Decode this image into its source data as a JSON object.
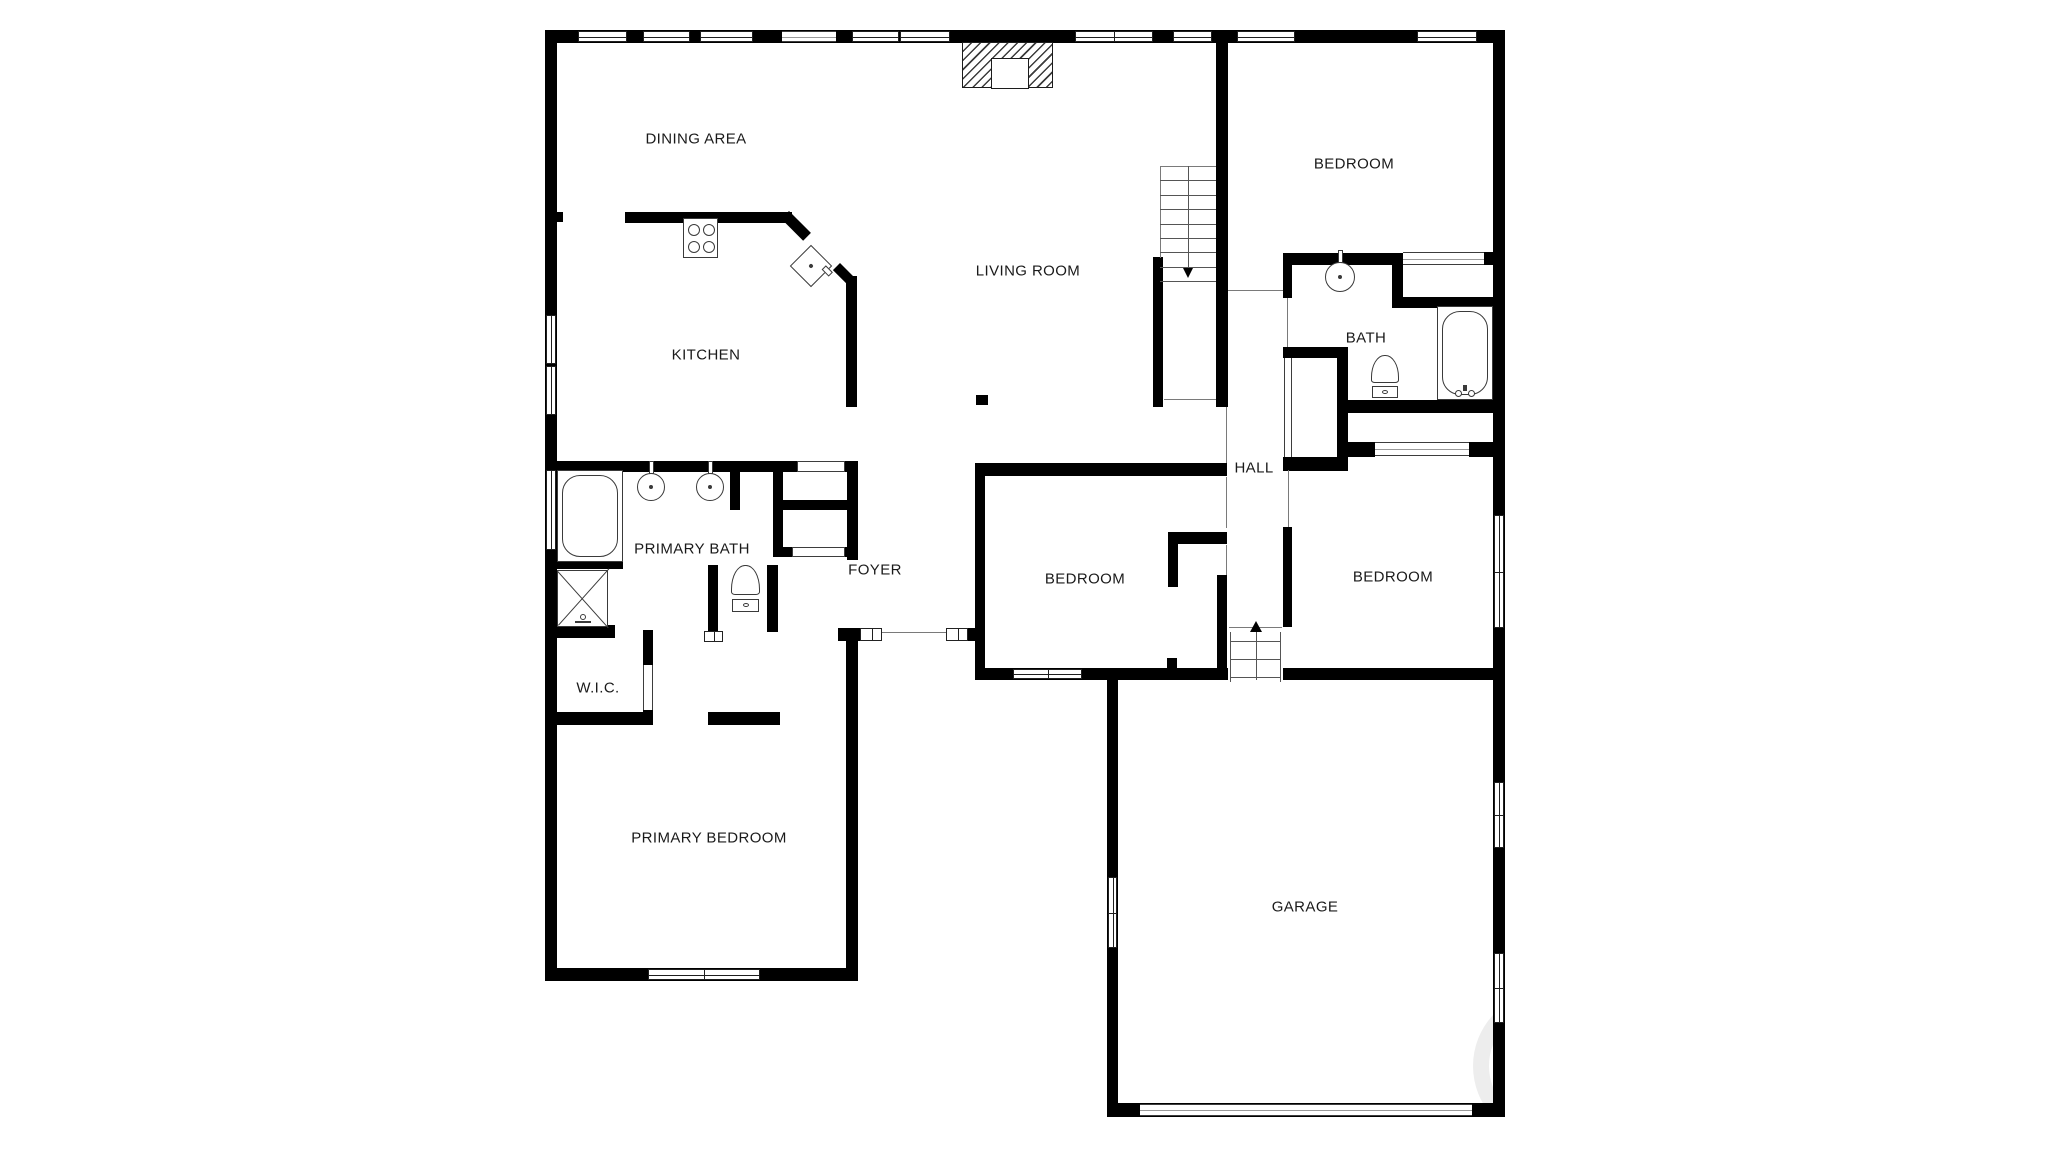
{
  "plan": {
    "width": 2048,
    "height": 1151,
    "colors": {
      "wall": "#000000",
      "fixture_line": "#3a3a3a",
      "thin_line": "#7a7a7a",
      "label": "#1a1a1a",
      "background": "#ffffff",
      "watermark": "rgba(0,0,0,0.07)"
    },
    "labels": [
      {
        "id": "dining-area",
        "text": "DINING AREA",
        "x": 696,
        "y": 139
      },
      {
        "id": "kitchen",
        "text": "KITCHEN",
        "x": 706,
        "y": 355
      },
      {
        "id": "living-room",
        "text": "LIVING ROOM",
        "x": 1028,
        "y": 271
      },
      {
        "id": "bedroom-top",
        "text": "BEDROOM",
        "x": 1354,
        "y": 164
      },
      {
        "id": "bath",
        "text": "BATH",
        "x": 1366,
        "y": 338
      },
      {
        "id": "hall",
        "text": "HALL",
        "x": 1254,
        "y": 468
      },
      {
        "id": "primary-bath",
        "text": "PRIMARY BATH",
        "x": 692,
        "y": 549
      },
      {
        "id": "foyer",
        "text": "FOYER",
        "x": 875,
        "y": 570
      },
      {
        "id": "bedroom-middle",
        "text": "BEDROOM",
        "x": 1085,
        "y": 579
      },
      {
        "id": "bedroom-right",
        "text": "BEDROOM",
        "x": 1393,
        "y": 577
      },
      {
        "id": "wic",
        "text": "W.I.C.",
        "x": 598,
        "y": 688
      },
      {
        "id": "primary-bedroom",
        "text": "PRIMARY BEDROOM",
        "x": 709,
        "y": 838
      },
      {
        "id": "garage",
        "text": "GARAGE",
        "x": 1305,
        "y": 907
      }
    ],
    "walls": [
      [
        545,
        30,
        960,
        13
      ],
      [
        545,
        30,
        12,
        951
      ],
      [
        1493,
        30,
        12,
        1087
      ],
      [
        545,
        968,
        313,
        13
      ],
      [
        846,
        632,
        12,
        349
      ],
      [
        625,
        212,
        167,
        11
      ],
      [
        548,
        212,
        15,
        10
      ],
      [
        846,
        276,
        11,
        131
      ],
      [
        976,
        395,
        12,
        10
      ],
      [
        545,
        461,
        313,
        11
      ],
      [
        730,
        467,
        10,
        43
      ],
      [
        773,
        461,
        10,
        96
      ],
      [
        773,
        500,
        85,
        10
      ],
      [
        847,
        461,
        11,
        99
      ],
      [
        773,
        547,
        20,
        10
      ],
      [
        845,
        547,
        13,
        10
      ],
      [
        545,
        558,
        78,
        11
      ],
      [
        545,
        625,
        70,
        13
      ],
      [
        708,
        565,
        10,
        70
      ],
      [
        643,
        630,
        10,
        35
      ],
      [
        643,
        710,
        10,
        14
      ],
      [
        545,
        712,
        108,
        13
      ],
      [
        708,
        712,
        72,
        13
      ],
      [
        767,
        565,
        11,
        67
      ],
      [
        838,
        628,
        22,
        13
      ],
      [
        968,
        628,
        12,
        13
      ],
      [
        975,
        463,
        252,
        13
      ],
      [
        975,
        463,
        10,
        217
      ],
      [
        975,
        668,
        253,
        12
      ],
      [
        1168,
        532,
        59,
        12
      ],
      [
        1168,
        544,
        10,
        43
      ],
      [
        1167,
        658,
        10,
        12
      ],
      [
        1217,
        575,
        10,
        95
      ],
      [
        1216,
        30,
        12,
        377
      ],
      [
        1153,
        257,
        10,
        150
      ],
      [
        1283,
        253,
        9,
        45
      ],
      [
        1283,
        347,
        65,
        11
      ],
      [
        1283,
        457,
        65,
        14
      ],
      [
        1337,
        347,
        11,
        123
      ],
      [
        1283,
        527,
        9,
        100
      ],
      [
        1283,
        253,
        120,
        12
      ],
      [
        1392,
        253,
        11,
        54
      ],
      [
        1392,
        297,
        101,
        11
      ],
      [
        1348,
        400,
        157,
        13
      ],
      [
        1348,
        442,
        27,
        15
      ],
      [
        1469,
        442,
        24,
        15
      ],
      [
        1484,
        252,
        21,
        13
      ],
      [
        1283,
        668,
        222,
        12
      ],
      [
        1107,
        680,
        11,
        437
      ],
      [
        1107,
        1103,
        398,
        14
      ]
    ],
    "diagonal_walls": [
      {
        "x": 789,
        "y": 211,
        "len": 31,
        "thick": 11,
        "angle": 45
      },
      {
        "x": 840,
        "y": 263,
        "len": 24,
        "thick": 10,
        "angle": 45
      }
    ],
    "windows": [
      {
        "x": 578,
        "y": 31,
        "w": 49,
        "h": 11,
        "dir": "h",
        "sashes": 1
      },
      {
        "x": 643,
        "y": 31,
        "w": 47,
        "h": 11,
        "dir": "h",
        "sashes": 1
      },
      {
        "x": 700,
        "y": 31,
        "w": 53,
        "h": 11,
        "dir": "h",
        "sashes": 1
      },
      {
        "x": 852,
        "y": 31,
        "w": 47,
        "h": 11,
        "dir": "h",
        "sashes": 1
      },
      {
        "x": 900,
        "y": 31,
        "w": 50,
        "h": 11,
        "dir": "h",
        "sashes": 1
      },
      {
        "x": 1075,
        "y": 31,
        "w": 78,
        "h": 11,
        "dir": "h",
        "sashes": 2
      },
      {
        "x": 1173,
        "y": 31,
        "w": 39,
        "h": 11,
        "dir": "h",
        "sashes": 1
      },
      {
        "x": 1237,
        "y": 31,
        "w": 58,
        "h": 11,
        "dir": "h",
        "sashes": 1
      },
      {
        "x": 1417,
        "y": 31,
        "w": 60,
        "h": 11,
        "dir": "h",
        "sashes": 1
      },
      {
        "x": 546,
        "y": 315,
        "w": 10,
        "h": 49,
        "dir": "v",
        "sashes": 1
      },
      {
        "x": 546,
        "y": 366,
        "w": 10,
        "h": 49,
        "dir": "v",
        "sashes": 1
      },
      {
        "x": 546,
        "y": 470,
        "w": 10,
        "h": 80,
        "dir": "v",
        "sashes": 1
      },
      {
        "x": 648,
        "y": 969,
        "w": 112,
        "h": 11,
        "dir": "h",
        "sashes": 2
      },
      {
        "x": 1013,
        "y": 669,
        "w": 69,
        "h": 10,
        "dir": "h",
        "sashes": 2
      },
      {
        "x": 1494,
        "y": 515,
        "w": 10,
        "h": 113,
        "dir": "v",
        "sashes": 2
      },
      {
        "x": 1494,
        "y": 782,
        "w": 10,
        "h": 66,
        "dir": "v",
        "sashes": 2
      },
      {
        "x": 1494,
        "y": 953,
        "w": 10,
        "h": 70,
        "dir": "v",
        "sashes": 2
      },
      {
        "x": 1108,
        "y": 877,
        "w": 9,
        "h": 71,
        "dir": "v",
        "sashes": 2
      }
    ],
    "openings": [
      {
        "x": 782,
        "y": 31,
        "w": 54,
        "h": 11,
        "dir": "h",
        "style": "slider",
        "name": "patio-opening"
      },
      {
        "x": 797,
        "y": 461,
        "w": 48,
        "h": 11,
        "dir": "h",
        "style": "cased",
        "name": "pantry-opening"
      },
      {
        "x": 792,
        "y": 547,
        "w": 53,
        "h": 10,
        "dir": "h",
        "style": "cased",
        "name": "closet-opening"
      },
      {
        "x": 860,
        "y": 628,
        "w": 22,
        "h": 13,
        "dir": "h",
        "style": "jamb",
        "name": "front-door-jamb"
      },
      {
        "x": 946,
        "y": 628,
        "w": 22,
        "h": 13,
        "dir": "h",
        "style": "jamb",
        "name": "front-door-jamb"
      },
      {
        "x": 704,
        "y": 631,
        "w": 19,
        "h": 11,
        "dir": "h",
        "style": "jamb",
        "name": "bath-door-jamb"
      },
      {
        "x": 1403,
        "y": 252,
        "w": 81,
        "h": 13,
        "dir": "h",
        "style": "slider",
        "name": "closet-slider"
      },
      {
        "x": 1375,
        "y": 442,
        "w": 94,
        "h": 14,
        "dir": "h",
        "style": "slider",
        "name": "closet-slider"
      },
      {
        "x": 1140,
        "y": 1104,
        "w": 332,
        "h": 12,
        "dir": "h",
        "style": "slider",
        "name": "garage-door"
      },
      {
        "x": 1284,
        "y": 358,
        "w": 8,
        "h": 99,
        "dir": "v",
        "style": "sliderv",
        "name": "linen-closet-opening"
      },
      {
        "x": 643,
        "y": 665,
        "w": 10,
        "h": 45,
        "dir": "v",
        "style": "sliderv",
        "name": "wic-door-opening"
      }
    ],
    "thin_lines": [
      [
        882,
        632,
        64,
        1
      ],
      [
        1229,
        627,
        53,
        1
      ],
      [
        1164,
        399,
        52,
        1
      ],
      [
        1228,
        290,
        55,
        1
      ],
      [
        1226,
        407,
        1,
        56
      ],
      [
        1226,
        477,
        1,
        51
      ],
      [
        1226,
        545,
        1,
        30
      ],
      [
        1287,
        298,
        1,
        49
      ],
      [
        1288,
        470,
        1,
        57
      ],
      [
        1160,
        166,
        1,
        92
      ],
      [
        1160,
        166,
        56,
        1
      ]
    ],
    "stairs": {
      "x": 1160,
      "y": 166,
      "w": 56,
      "h": 115,
      "treads": 8,
      "center_x": 1188,
      "line_top": 166,
      "line_bottom": 268,
      "direction": "down"
    },
    "entry_steps": {
      "x": 1230,
      "y": 632,
      "w": 51,
      "bottom": 682,
      "treads_y": [
        641,
        659,
        677
      ],
      "center_x": 1256,
      "arrow_tip_y": 621,
      "direction": "up"
    },
    "fireplace": {
      "x": 962,
      "y": 42,
      "w": 91,
      "h": 46,
      "firebox": {
        "x": 990,
        "y": 57,
        "w": 38,
        "h": 31
      }
    },
    "fixtures": [
      {
        "type": "stove",
        "x": 683,
        "y": 218,
        "w": 35,
        "h": 40
      },
      {
        "type": "island-sink",
        "cx": 811,
        "cy": 266,
        "size": 30
      },
      {
        "type": "sink",
        "cx": 651,
        "cy": 487,
        "r": 14
      },
      {
        "type": "sink",
        "cx": 710,
        "cy": 487,
        "r": 14
      },
      {
        "type": "sink",
        "cx": 1340,
        "cy": 277,
        "r": 15
      },
      {
        "type": "toilet",
        "x": 731,
        "y": 565,
        "w": 29,
        "h": 47
      },
      {
        "type": "toilet",
        "x": 1371,
        "y": 355,
        "w": 28,
        "h": 43
      },
      {
        "type": "bathtub",
        "x": 557,
        "y": 470,
        "w": 66,
        "h": 92,
        "faucet": false
      },
      {
        "type": "bathtub",
        "x": 1437,
        "y": 306,
        "w": 56,
        "h": 94,
        "faucet": true
      },
      {
        "type": "shower",
        "x": 557,
        "y": 570,
        "w": 51,
        "h": 57
      }
    ],
    "watermark": {
      "clip": {
        "x": 1118,
        "y": 680,
        "w": 375,
        "h": 423
      },
      "cx": 1548,
      "cy": 1066,
      "r": 75,
      "stroke": 16
    }
  }
}
